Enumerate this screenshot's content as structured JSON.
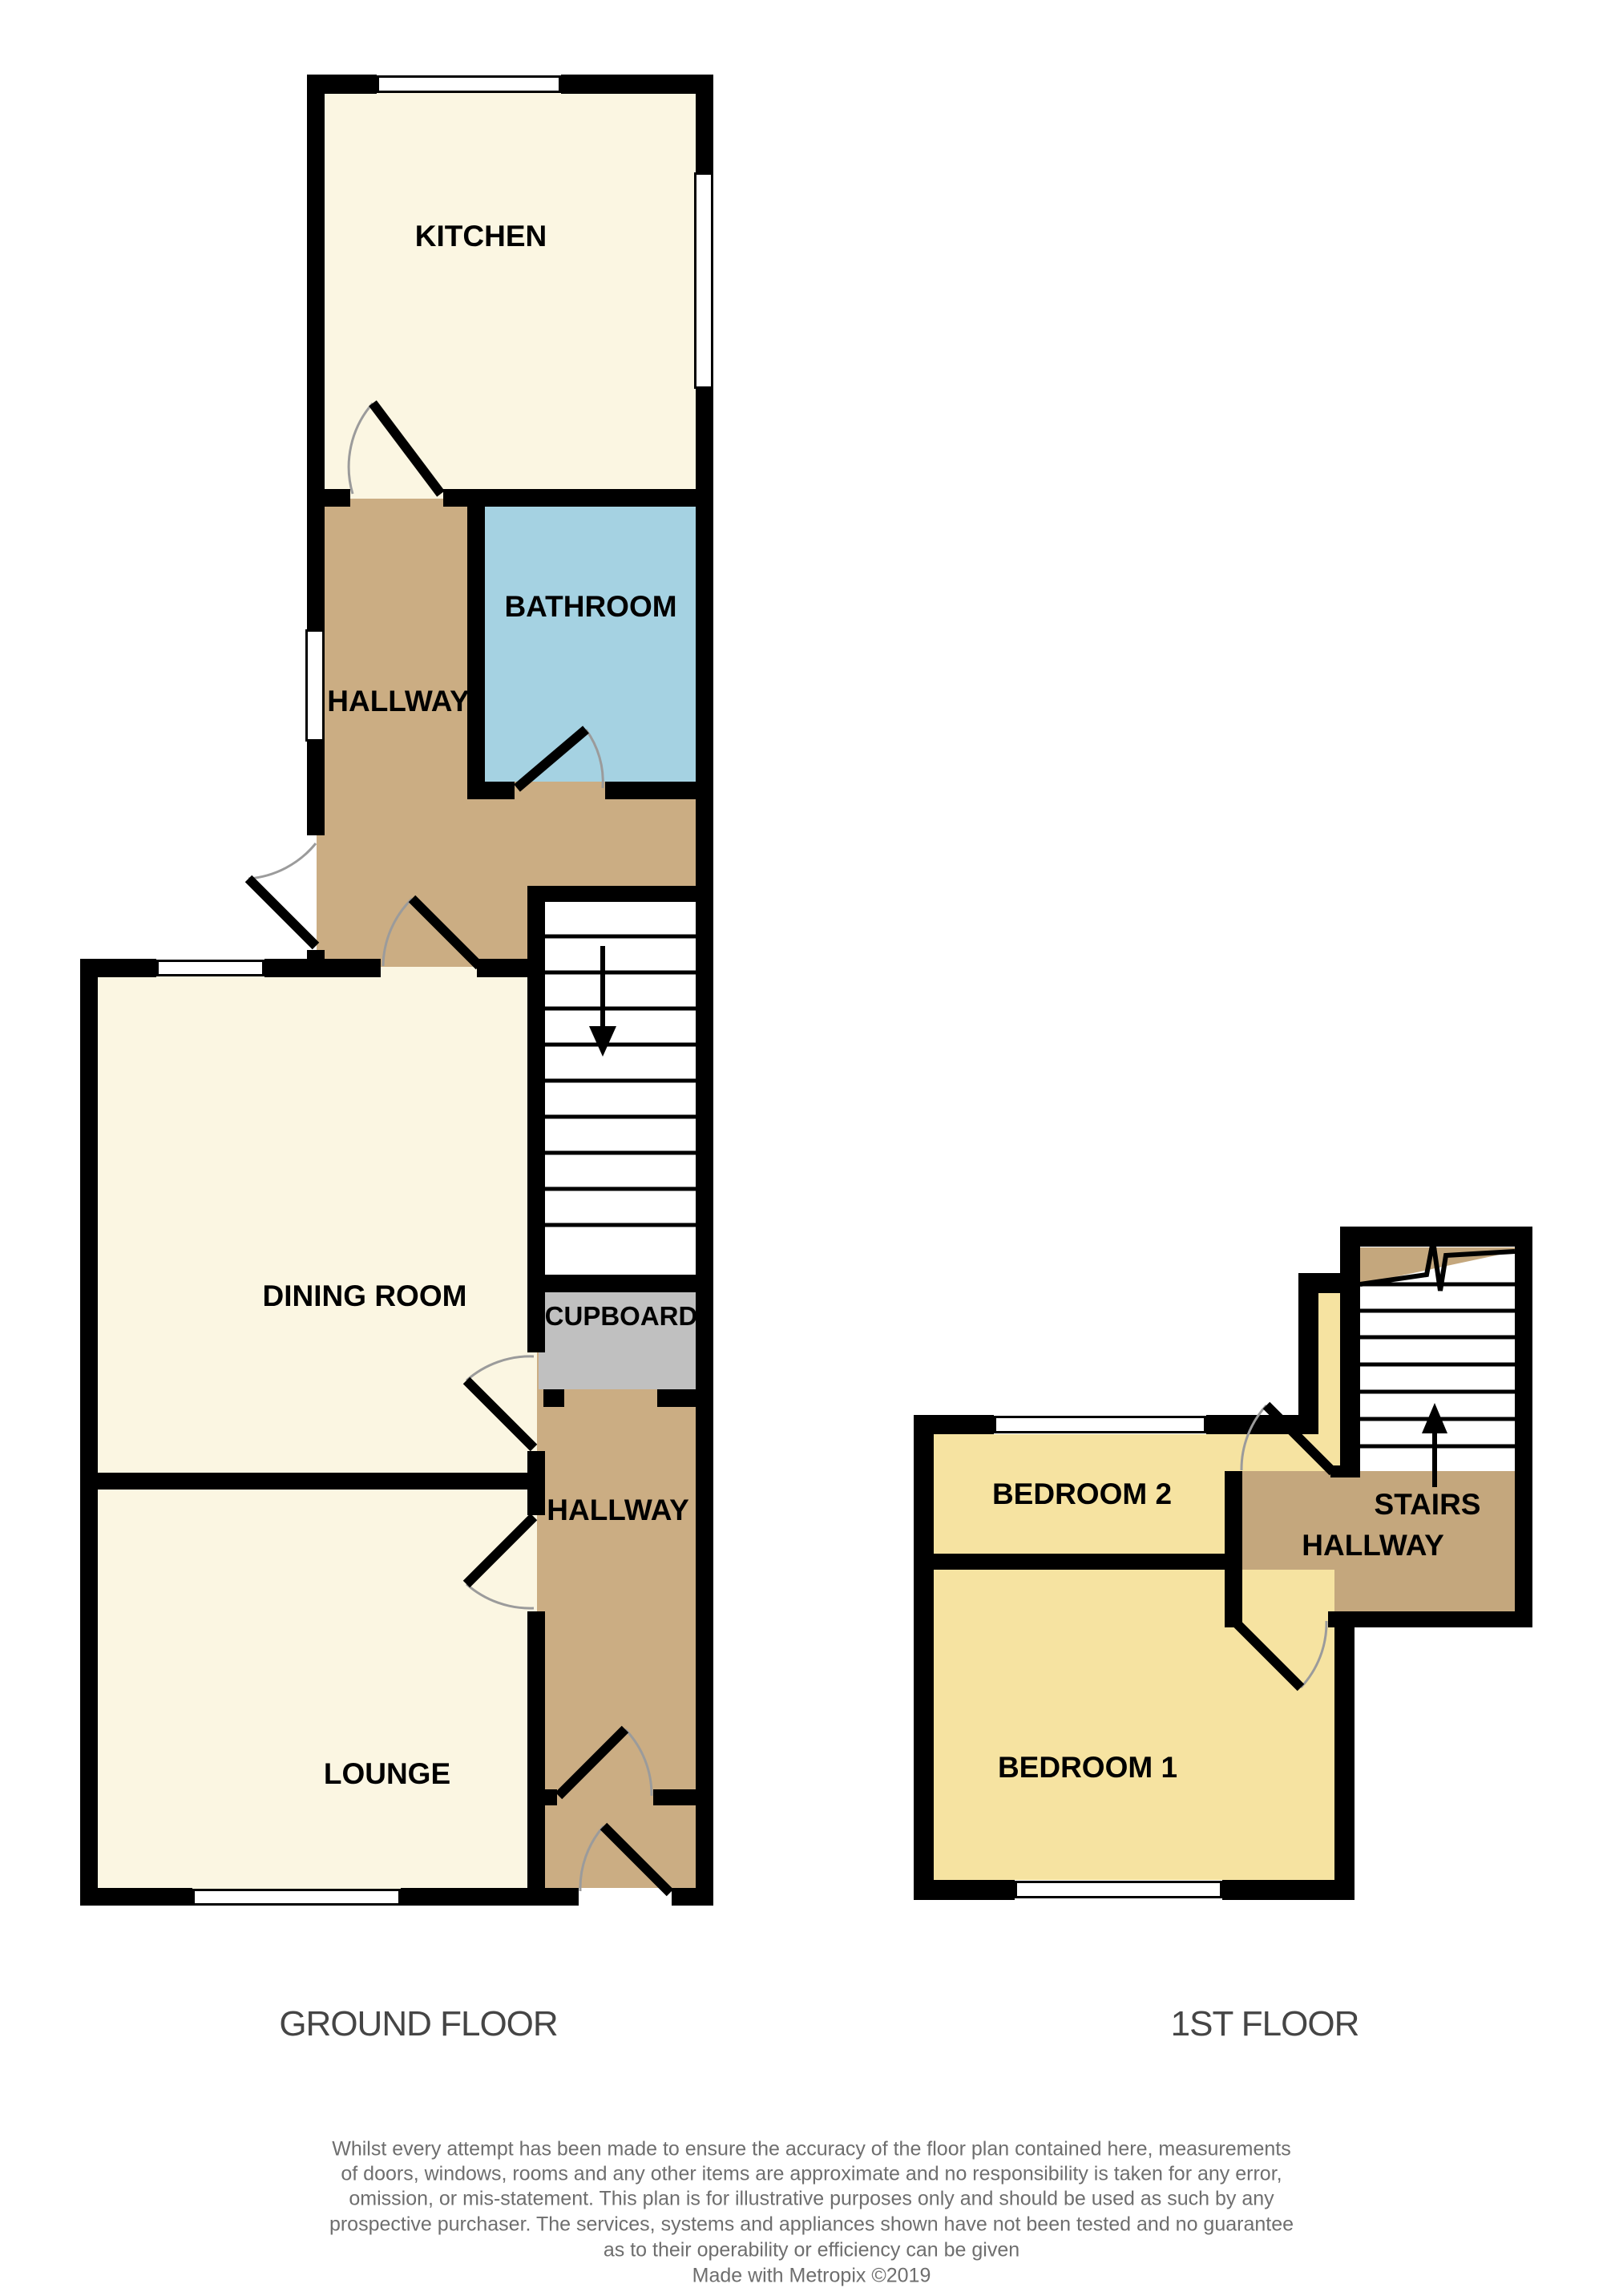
{
  "title": "Floor plan",
  "rooms": {
    "kitchen": "KITCHEN",
    "bathroom": "BATHROOM",
    "hallway_upper": "HALLWAY",
    "dining": "DINING ROOM",
    "cupboard": "CUPBOARD",
    "hallway_lower": "HALLWAY",
    "lounge": "LOUNGE",
    "bedroom2": "BEDROOM 2",
    "stairs_label": "STAIRS",
    "stairs_hallway": "HALLWAY",
    "bedroom1": "BEDROOM 1"
  },
  "floors": {
    "ground": "GROUND FLOOR",
    "first": "1ST FLOOR"
  },
  "footer": {
    "line1": "Whilst every attempt has been made to ensure the accuracy of the floor plan contained here, measurements",
    "line2": "of doors, windows, rooms and any other items are approximate and no responsibility is taken for any error,",
    "line3": "omission, or mis-statement. This plan is for illustrative purposes only and should be used as such by any",
    "line4": "prospective purchaser. The services, systems and appliances shown have not been tested and no guarantee",
    "line5": "as to their operability or efficiency can be given",
    "credit": "Made with Metropix ©2019"
  },
  "colors": {
    "room_cream": "#FBF6E2",
    "room_yellow": "#F6E3A1",
    "hallway_tan": "#CBAD83",
    "landing_tan": "#C4A77D",
    "bathroom_blue": "#A5D2E2",
    "cupboard_gray": "#C0C0C0",
    "wall_black": "#000000",
    "arc_gray": "#9B9B9B",
    "text_gray": "#6E6E6E"
  }
}
